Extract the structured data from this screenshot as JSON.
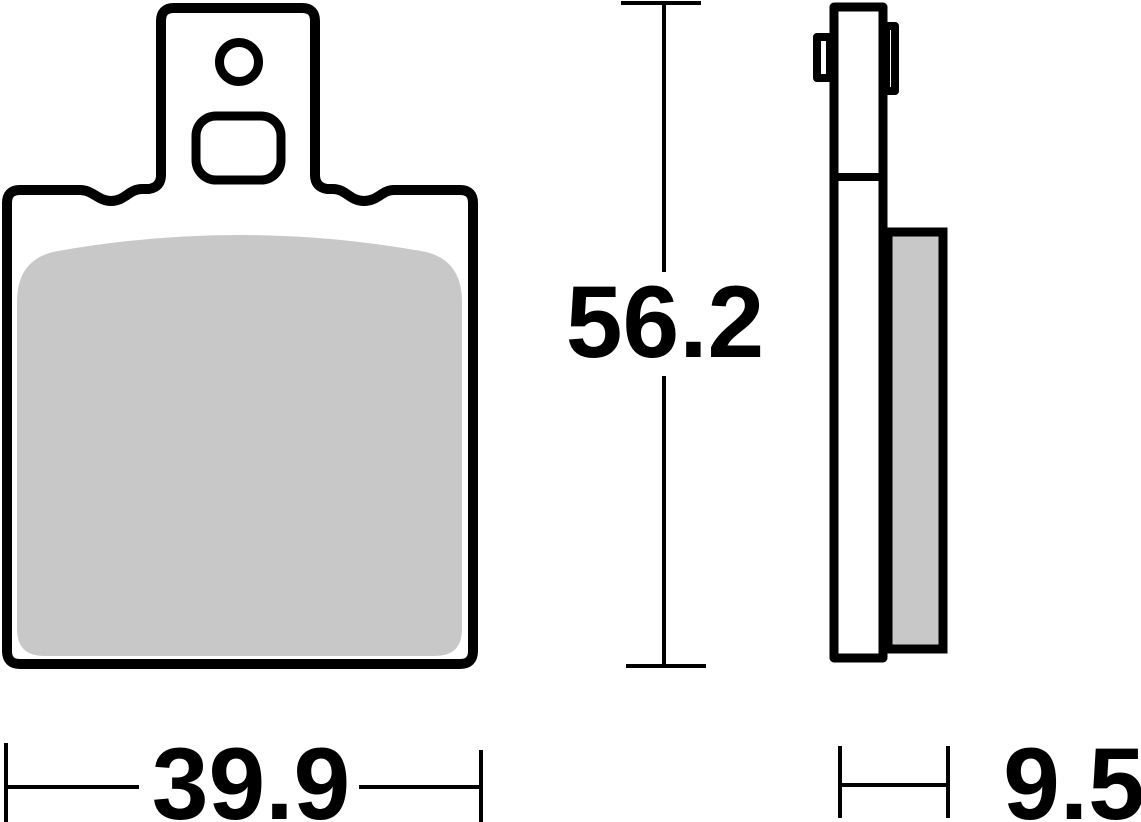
{
  "labels": {
    "height": "56.2",
    "width": "39.9",
    "thickness": "9.5"
  },
  "colors": {
    "line": "#000000",
    "pad-fill": "#c8c8c8",
    "background": "#ffffff"
  }
}
